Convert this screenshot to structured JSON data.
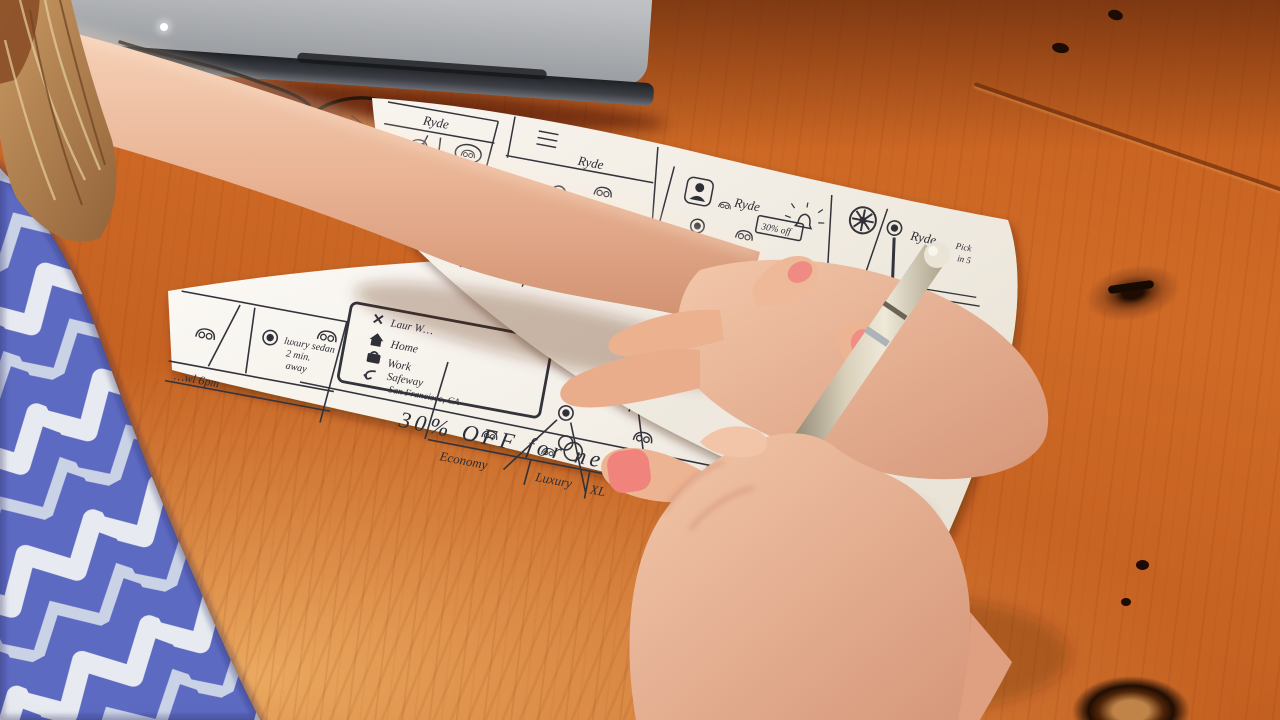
{
  "colors": {
    "desk_wood": "#c9641f",
    "paper": "#f7f4ee",
    "ink": "#33333b",
    "shirt_blue": "#5d6ac1",
    "shirt_white": "#e7ebf1",
    "nail_pink": "#ef8b82",
    "laptop_silver": "#b9bbbe",
    "pen_champagne": "#cfc5ad"
  },
  "paper_top": {
    "frames": [
      {
        "title": "Ryde",
        "pin_line1": "luxury sedan",
        "pin_line2": "2 min away"
      },
      {
        "title": "Ryde"
      },
      {
        "title": "Ryde",
        "promo": "30% off"
      },
      {
        "title": "Ryde",
        "pickup1": "Pick",
        "pickup2": "in 5",
        "row1": "Cars Ne…",
        "row1_price": "$18",
        "row2": "…nd",
        "row2_price": "$30"
      }
    ]
  },
  "paper_bottom": {
    "map_frame": {
      "pin_line1": "luxury sedan",
      "pin_line2": "2 min.",
      "pin_line3": "away",
      "status_row": "…wl 6pm"
    },
    "menu": {
      "items": [
        {
          "icon": "close-x-icon",
          "label": "Laur W…"
        },
        {
          "icon": "home-icon",
          "label": "Home"
        },
        {
          "icon": "work-briefcase-icon",
          "label": "Work"
        },
        {
          "icon": "back-arrow-icon",
          "label": "Safeway",
          "sublabel": "San Francisco, CA"
        }
      ]
    },
    "banner": "30% OFF for next 30min",
    "ride_tiers": {
      "tabs": [
        "Economy",
        "Luxury",
        "XL"
      ]
    },
    "detail_frame": {
      "seats": "4 seats"
    }
  }
}
